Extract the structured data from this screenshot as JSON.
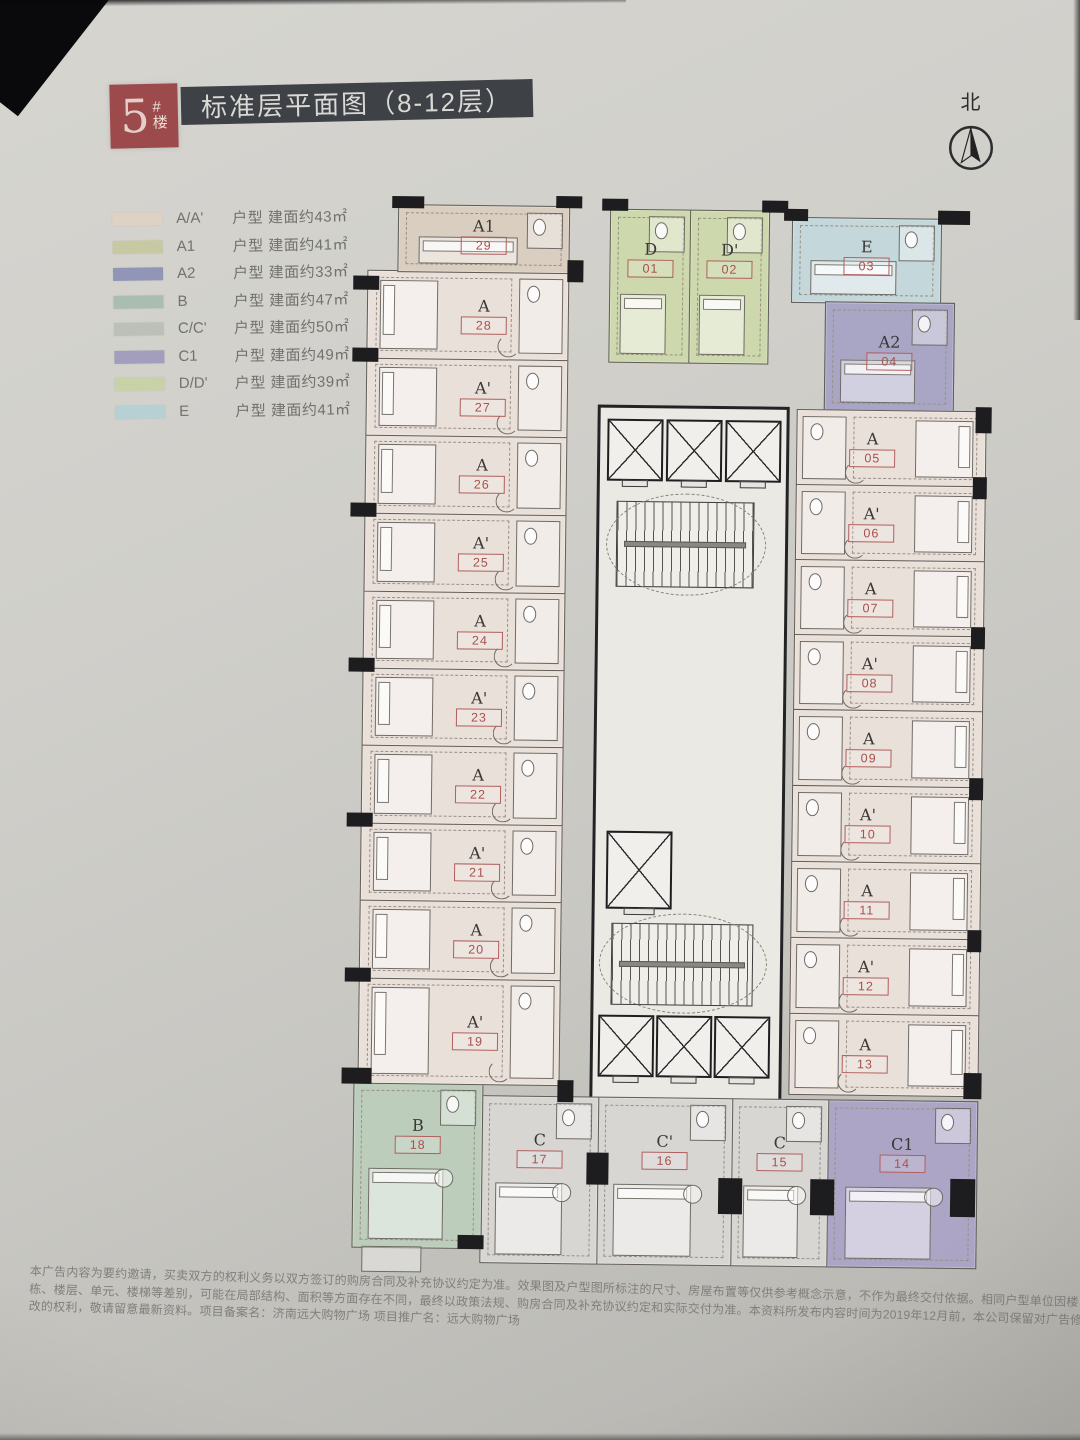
{
  "page": {
    "building_badge": {
      "number": "5",
      "suffix_chars": [
        "#",
        "楼"
      ]
    },
    "title": "标准层平面图（8-12层）",
    "north_label": "北"
  },
  "legend": {
    "items": [
      {
        "label": "A/A'",
        "desc": "户型 建面约43㎡",
        "color": "#ddd2c4"
      },
      {
        "label": "A1",
        "desc": "户型 建面约41㎡",
        "color": "#c7c9a2"
      },
      {
        "label": "A2",
        "desc": "户型 建面约33㎡",
        "color": "#9195b6"
      },
      {
        "label": "B",
        "desc": "户型 建面约47㎡",
        "color": "#a9beb1"
      },
      {
        "label": "C/C'",
        "desc": "户型 建面约50㎡",
        "color": "#bdc0b9"
      },
      {
        "label": "C1",
        "desc": "户型 建面约49㎡",
        "color": "#a39ebb"
      },
      {
        "label": "D/D'",
        "desc": "户型 建面约39㎡",
        "color": "#c7d2a6"
      },
      {
        "label": "E",
        "desc": "户型 建面约41㎡",
        "color": "#b7d0d4"
      }
    ]
  },
  "plan": {
    "type_colors": {
      "A": "#eae0da",
      "A1": "#d9cec0",
      "A2": "#a8a6c4",
      "B": "#bccdbb",
      "C": "#d8d6d3",
      "C1": "#ada5c5",
      "D": "#cdd8ad",
      "E": "#c4d7da"
    },
    "units": [
      {
        "no": "01",
        "type": "D"
      },
      {
        "no": "02",
        "type": "D'"
      },
      {
        "no": "03",
        "type": "E"
      },
      {
        "no": "04",
        "type": "A2"
      },
      {
        "no": "05",
        "type": "A"
      },
      {
        "no": "06",
        "type": "A'"
      },
      {
        "no": "07",
        "type": "A"
      },
      {
        "no": "08",
        "type": "A'"
      },
      {
        "no": "09",
        "type": "A"
      },
      {
        "no": "10",
        "type": "A'"
      },
      {
        "no": "11",
        "type": "A"
      },
      {
        "no": "12",
        "type": "A'"
      },
      {
        "no": "13",
        "type": "A"
      },
      {
        "no": "14",
        "type": "C1"
      },
      {
        "no": "15",
        "type": "C"
      },
      {
        "no": "16",
        "type": "C'"
      },
      {
        "no": "17",
        "type": "C"
      },
      {
        "no": "18",
        "type": "B"
      },
      {
        "no": "19",
        "type": "A'"
      },
      {
        "no": "20",
        "type": "A"
      },
      {
        "no": "21",
        "type": "A'"
      },
      {
        "no": "22",
        "type": "A"
      },
      {
        "no": "23",
        "type": "A'"
      },
      {
        "no": "24",
        "type": "A"
      },
      {
        "no": "25",
        "type": "A'"
      },
      {
        "no": "26",
        "type": "A"
      },
      {
        "no": "27",
        "type": "A'"
      },
      {
        "no": "28",
        "type": "A"
      },
      {
        "no": "29",
        "type": "A1"
      }
    ]
  },
  "disclaimer": {
    "lines": [
      "本广告内容为要约邀请，买卖双方的权利义务以双方签订的购房合同及补充协议约定为准。效果图及户型图所标注的尺寸、房屋布置等仅供参考概念示意，不作为最终交付依据。相同户型单位因楼",
      "栋、楼层、单元、楼梯等差别，可能在局部结构、面积等方面存在不同，最终以政策法规、购房合同及补充协议约定和实际交付为准。本资料所发布内容时间为2019年12月前，本公司保留对广告修",
      "改的权利，敬请留意最新资料。项目备案名：济南远大购物广场 项目推广名：远大购物广场"
    ]
  }
}
